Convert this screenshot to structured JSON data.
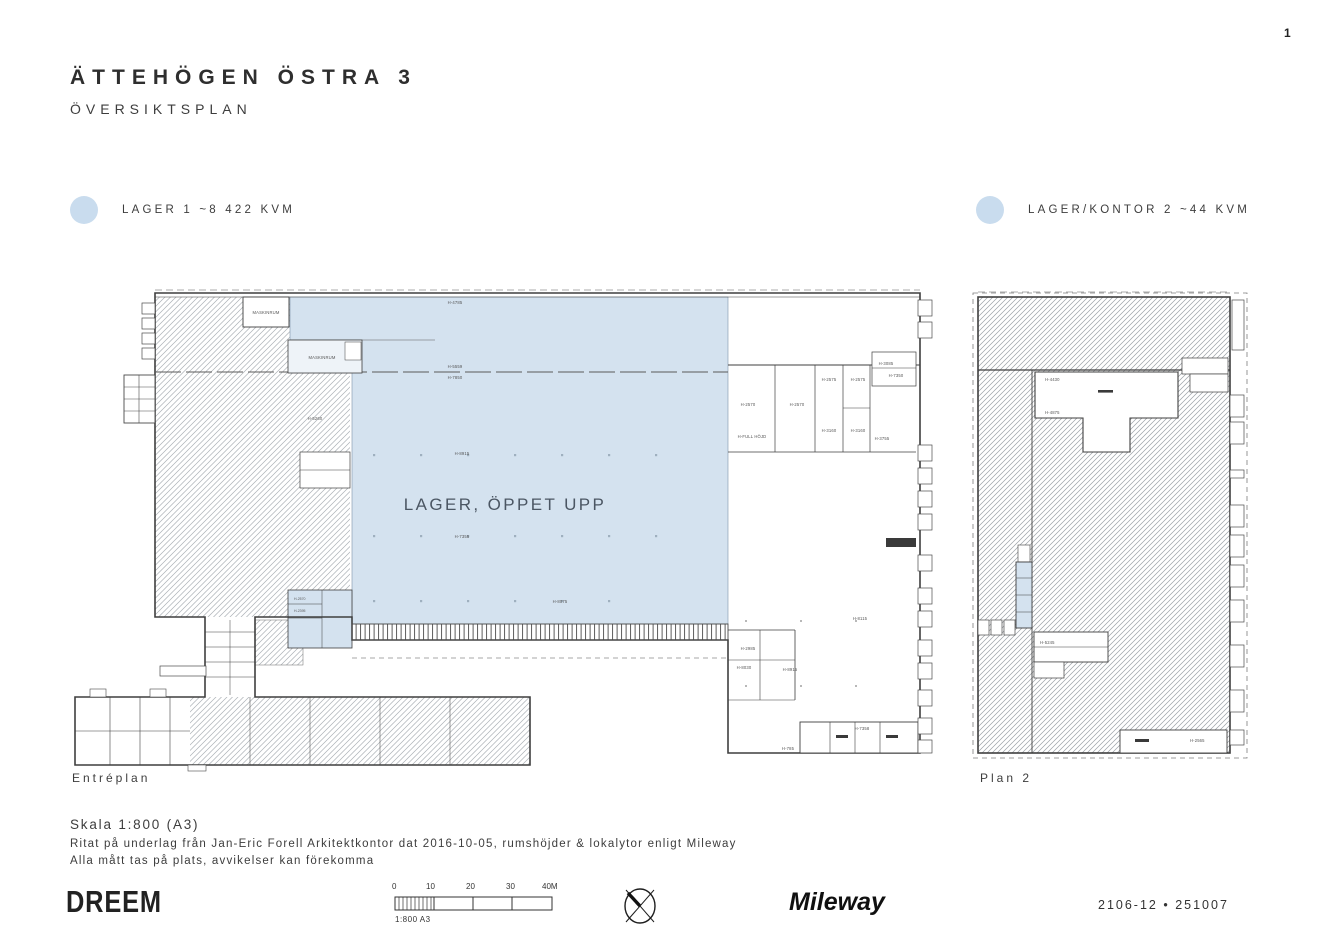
{
  "page": {
    "number": "1",
    "title": "ÄTTEHÖGEN ÖSTRA 3",
    "subtitle": "ÖVERSIKTSPLAN"
  },
  "legend": [
    {
      "label": "LAGER 1 ~8 422 KVM",
      "color": "#c9dcee"
    },
    {
      "label": "LAGER/KONTOR 2 ~44 KVM",
      "color": "#c9dcee"
    }
  ],
  "plans": {
    "entreplan": {
      "caption": "Entréplan",
      "area_label": "LAGER, ÖPPET UPP",
      "labels": {
        "maskinrum1": "MASKINRUM",
        "maskinrum2": "MASKINRUM",
        "h4785": "H-4785",
        "h5559": "H-5559",
        "h7850": "H-7850",
        "h5260": "H-5260",
        "h8915a": "H-8915",
        "h7355": "H-7355",
        "h8075": "H-8075",
        "h2570a": "H-2570",
        "h2570b": "H-2570",
        "h2575a": "H-2575",
        "h2575b": "H-2575",
        "h3160a": "H-3160",
        "h3160b": "H-3160",
        "hfull": "H-FULL HÖJD",
        "h3085": "H-3085",
        "h7350": "H-7350",
        "h3755": "H-3755",
        "h8115": "H-8115",
        "h2985": "H-2985",
        "h8030": "H-8030",
        "h8915b": "H-8915",
        "h7358": "H-7358",
        "h785": "H-785",
        "wc1": "H-2570",
        "wc2": "H-2395"
      }
    },
    "plan2": {
      "caption": "Plan 2",
      "labels": {
        "h4430": "H-4430",
        "h4875": "H-4875",
        "h5245": "H-5245",
        "h2565": "H-2565"
      }
    }
  },
  "notes": {
    "scale": "Skala 1:800 (A3)",
    "line1": "Ritat på underlag från Jan-Eric Forell Arkitektkontor dat 2016-10-05, rumshöjder & lokalytor enligt Mileway",
    "line2": "Alla mått tas på plats, avvikelser kan förekomma"
  },
  "footer": {
    "logo_left": "DREEM",
    "logo_right": "Mileway",
    "doc_number": "2106-12  •  251007",
    "scalebar": {
      "ticks": [
        "0",
        "10",
        "20",
        "30",
        "40M"
      ],
      "caption": "1:800 A3"
    }
  },
  "colors": {
    "highlight_fill": "#d4e2ef",
    "legend_dot": "#c9dcee",
    "wall": "#3f3f3f",
    "hatch": "#aab0b5"
  }
}
